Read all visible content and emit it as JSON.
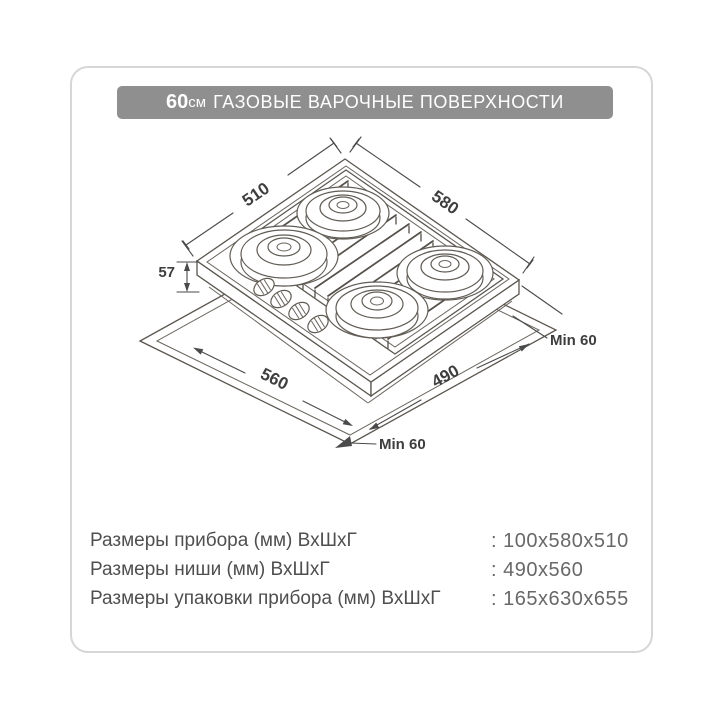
{
  "header": {
    "size_value": "60",
    "size_unit": "см",
    "title_rest": "ГАЗОВЫЕ ВАРОЧНЫЕ ПОВЕРХНОСТИ"
  },
  "diagram": {
    "dim_top_left": "510",
    "dim_top_right": "580",
    "dim_side_height": "57",
    "dim_niche_front_left": "560",
    "dim_niche_front_right": "490",
    "min_clearance_right": "Min 60",
    "min_clearance_bottom": "Min 60"
  },
  "specs": {
    "rows": [
      {
        "label": "Размеры прибора (мм) ВхШхГ",
        "value": ": 100x580x510"
      },
      {
        "label": "Размеры ниши (мм) ВхШхГ",
        "value": ": 490x560"
      },
      {
        "label": "Размеры упаковки прибора (мм) ВхШхГ",
        "value": ": 165x630x655"
      }
    ]
  },
  "colors": {
    "header_bg": "#8f8f8f",
    "header_text": "#ffffff",
    "card_border": "#d6d6d6",
    "drawing_line": "#5b564f",
    "label_text": "#4f4f4f",
    "value_text": "#686868"
  }
}
